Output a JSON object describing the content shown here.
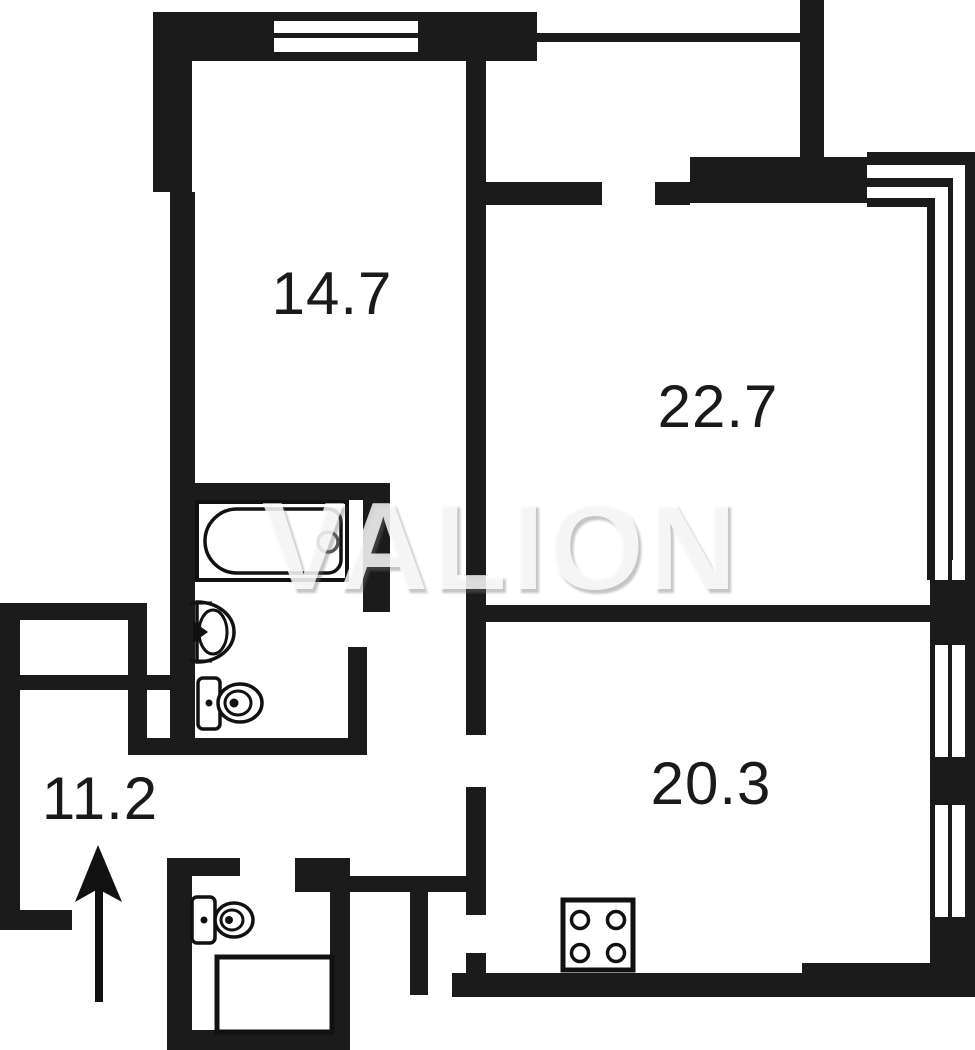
{
  "title": "apartment floor plan",
  "watermark": {
    "text": "VALION",
    "color": "#ffffff"
  },
  "rooms": [
    {
      "id": "bedroom",
      "label": "14.7"
    },
    {
      "id": "living-room",
      "label": "22.7"
    },
    {
      "id": "kitchen",
      "label": "20.3"
    },
    {
      "id": "hallway",
      "label": "11.2"
    }
  ],
  "fixtures": [
    "bathtub",
    "bathroom-sink",
    "bathroom-toilet",
    "wc-toilet",
    "shower-tray",
    "stove-4-burners",
    "entrance-arrow"
  ],
  "colors": {
    "wall": "#1b1b1b",
    "background": "#ffffff",
    "label": "#1a1a1a",
    "watermark_shadow": "#6e6e6e"
  }
}
